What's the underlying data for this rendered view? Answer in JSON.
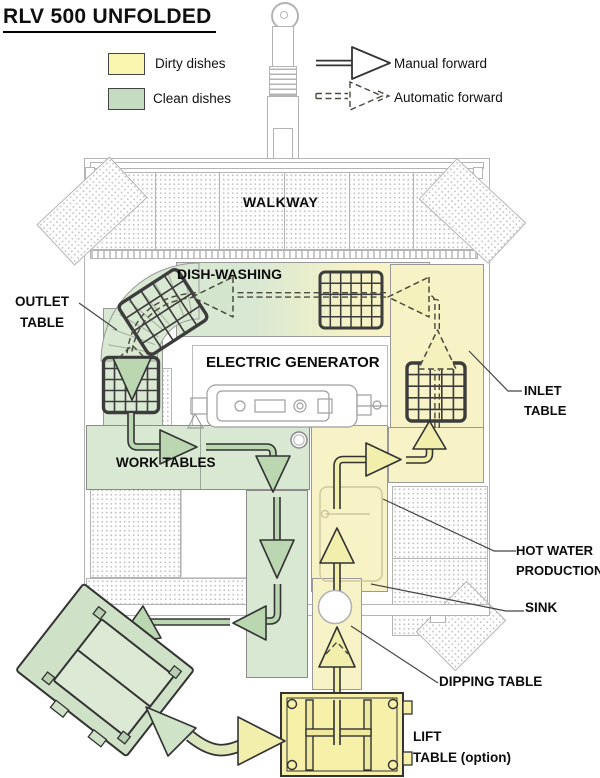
{
  "title": "RLV 500 UNFOLDED",
  "legend": {
    "dirty": "Dirty dishes",
    "clean": "Clean dishes",
    "manual": "Manual forward",
    "automatic": "Automatic forward"
  },
  "areas": {
    "walkway": "WALKWAY",
    "dish_washing": "DISH-WASHING",
    "outlet_1": "OUTLET",
    "outlet_2": "TABLE",
    "generator": "ELECTRIC GENERATOR",
    "inlet_1": "INLET",
    "inlet_2": "TABLE",
    "work_tables": "WORK TABLES",
    "hot_water_1": "HOT WATER",
    "hot_water_2": "PRODUCTION",
    "sink": "SINK",
    "dipping_table": "DIPPING TABLE",
    "lift_1": "LIFT",
    "lift_2": "TABLE (option)"
  },
  "colors": {
    "dirty_swatch": "#faf6b0",
    "clean_swatch": "#c6dcc2",
    "dirty_region": "#f7f3c6",
    "clean_region": "#d9e8d3",
    "dirty_arrow": "#f2eeab",
    "dirty_arrow_pale": "#f5f1bc",
    "clean_arrow": "#bad7b1",
    "clean_arrow_pale": "#d4e5cd",
    "line_art": "#b4b4b4"
  }
}
